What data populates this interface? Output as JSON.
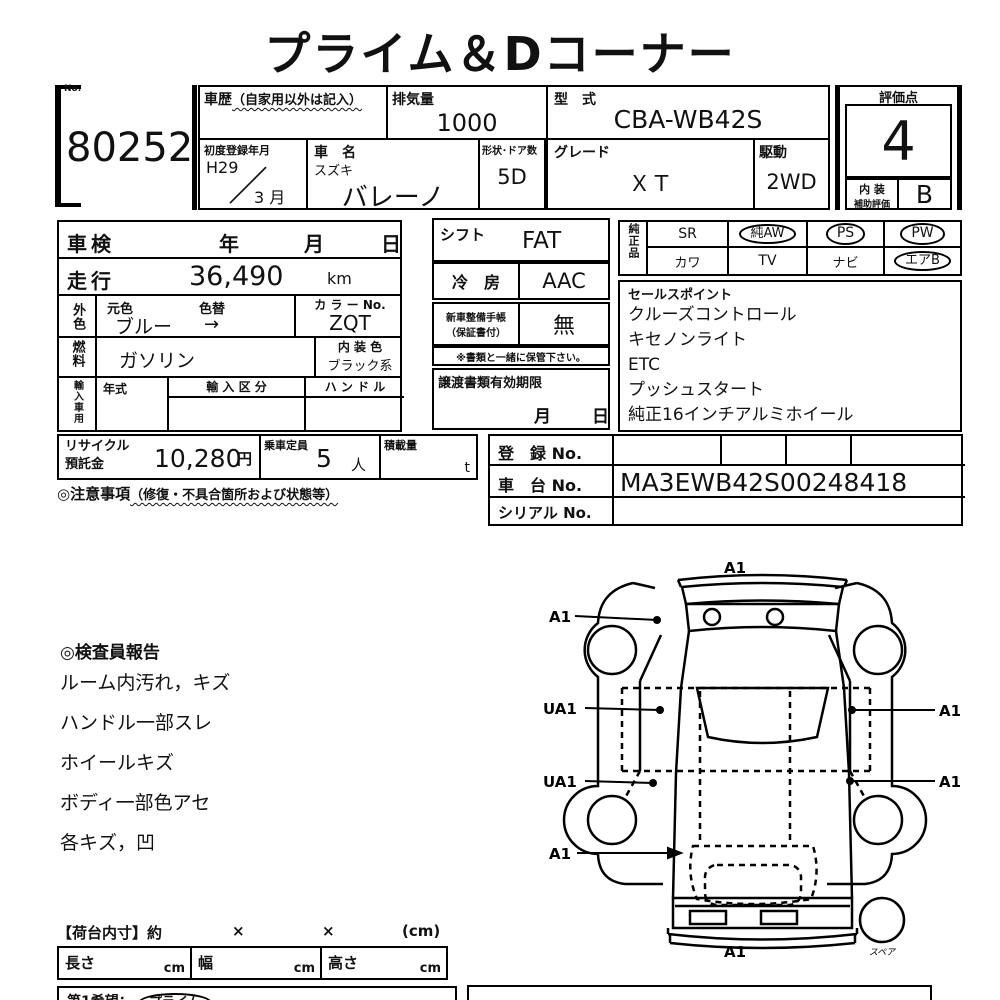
{
  "title": "プライム＆Dコーナー",
  "header": {
    "no_label": "No.",
    "lot_no": "80252",
    "history_label": "車歴",
    "history_note": "（自家用以外は記入）",
    "displacement_label": "排気量",
    "displacement_value": "1000",
    "model_code_label": "型　式",
    "model_code_value": "CBA-WB42S",
    "first_reg_label": "初度登録年月",
    "first_reg_year": "H29",
    "first_reg_month": "3 月",
    "car_name_label": "車　名",
    "maker": "スズキ",
    "car_name": "バレーノ",
    "shape_doors_label": "形状･ドア数",
    "shape_doors_value": "5D",
    "grade_label": "グレード",
    "grade_value": "ＸＴ",
    "drive_label": "駆動",
    "drive_value": "2WD",
    "score_label": "評価点",
    "score_value": "4",
    "interior_label_1": "内 装",
    "interior_label_2": "補助評価",
    "interior_value": "B"
  },
  "inspection": {
    "shaken_label": "車検",
    "year_label": "年",
    "month_label": "月",
    "day_label": "日",
    "mileage_label": "走行",
    "mileage_value": "36,490",
    "mileage_unit": "km",
    "ext_color_label": "外色",
    "orig_color_label": "元色",
    "color_change_label": "色替",
    "orig_color_value": "ブルー",
    "color_change_arrow": "→",
    "color_no_label": "カ ラ ー No.",
    "color_no_value": "ZQT",
    "fuel_label": "燃料",
    "fuel_value": "ガソリン",
    "int_color_label": "内 装 色",
    "int_color_value": "ブラック系",
    "import_label": "輸入車用",
    "import_year_label": "年式",
    "import_class_label": "輸 入 区 分",
    "handle_label": "ハ ン ド ル",
    "recycle_label_1": "リサイクル",
    "recycle_label_2": "預託金",
    "recycle_value": "10,280",
    "recycle_unit": "円",
    "capacity_label": "乗車定員",
    "capacity_value": "5",
    "capacity_unit": "人",
    "load_label": "積載量",
    "load_unit": "t",
    "notes_label": "◎注意事項",
    "notes_note": "（修復・不具合箇所および状態等）"
  },
  "right_panel": {
    "shift_label": "シフト",
    "shift_value": "FAT",
    "ac_label": "冷　房",
    "ac_value": "AAC",
    "manual_label_1": "新車整備手帳",
    "manual_label_2": "（保証書付）",
    "manual_value": "無",
    "manual_note": "※書類と一緒に保管下さい。",
    "transfer_label": "譲渡書類有効期限",
    "transfer_month": "月",
    "transfer_day": "日"
  },
  "oem": {
    "label": "純正品",
    "items": [
      {
        "label": "SR",
        "circled": false
      },
      {
        "label": "純AW",
        "circled": true
      },
      {
        "label": "PS",
        "circled": true
      },
      {
        "label": "PW",
        "circled": true
      },
      {
        "label": "カワ",
        "circled": false
      },
      {
        "label": "TV",
        "circled": false
      },
      {
        "label": "ナビ",
        "circled": false
      },
      {
        "label": "エアB",
        "circled": true
      }
    ]
  },
  "sales_points": {
    "label": "セールスポイント",
    "items": [
      "クルーズコントロール",
      "キセノンライト",
      "ETC",
      "プッシュスタート",
      "純正16インチアルミホイール"
    ]
  },
  "registration": {
    "reg_no_label": "登　録 No.",
    "reg_no_value": "",
    "chassis_no_label": "車　台 No.",
    "chassis_no_value": "MA3EWB42S00248418",
    "serial_no_label": "シリアル No.",
    "serial_no_value": ""
  },
  "inspector_report": {
    "title": "◎検査員報告",
    "items": [
      "ルーム内汚れ，キズ",
      "ハンドル一部スレ",
      "ホイールキズ",
      "ボディ一部色アセ",
      "各キズ，凹"
    ]
  },
  "diagram": {
    "front": "A1",
    "left_top": "A1",
    "left_mid_upper": "UA1",
    "left_mid_lower": "UA1",
    "left_rear": "A1",
    "right_upper": "A1",
    "right_lower": "A1",
    "rear": "A1",
    "spare": "スペア"
  },
  "cargo": {
    "title": "【荷台内寸】約",
    "x1": "×",
    "x2": "×",
    "unit": "(cm)",
    "length_label": "長さ",
    "length_unit": "cm",
    "width_label": "幅",
    "width_unit": "cm",
    "height_label": "高さ",
    "height_unit": "cm",
    "wish_label": "第1希望：",
    "wish_value": "プライム"
  },
  "colors": {
    "ink": "#111111",
    "paper": "#ffffff"
  }
}
